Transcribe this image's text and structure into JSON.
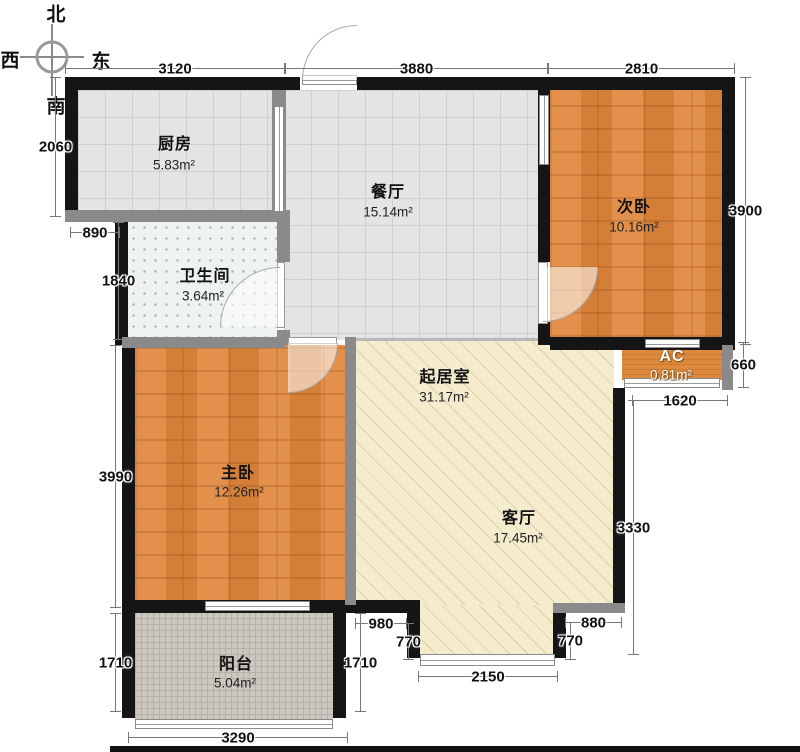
{
  "title": "两室户型图",
  "compass": {
    "north": "北",
    "west": "西",
    "east": "东",
    "south": "南",
    "cx": 52,
    "cy": 57,
    "r": 15,
    "labels": [
      {
        "key": "north",
        "x": 56,
        "y": 13
      },
      {
        "key": "west",
        "x": 10,
        "y": 59
      },
      {
        "key": "east",
        "x": 101,
        "y": 60
      },
      {
        "key": "south",
        "x": 56,
        "y": 105
      }
    ]
  },
  "colors": {
    "wall_exterior": "#151515",
    "wall_interior": "#8a8a8a",
    "wood_floor": "#e0873c",
    "tile_floor": "#e4e4e6",
    "living_floor": "#f5ecce",
    "balcony_floor": "#ccc8c0",
    "bath_floor": "#eef2f0",
    "dim_line": "#777777"
  },
  "floors": [
    {
      "id": "kitchen",
      "type": "tile",
      "rect": [
        78,
        90,
        196,
        122
      ]
    },
    {
      "id": "dining",
      "type": "tile",
      "rect": [
        284,
        90,
        256,
        250
      ]
    },
    {
      "id": "bedroom2",
      "type": "wood",
      "rect": [
        550,
        90,
        172,
        247
      ]
    },
    {
      "id": "bathroom",
      "type": "bath",
      "rect": [
        128,
        222,
        150,
        116
      ]
    },
    {
      "id": "master",
      "type": "wood",
      "rect": [
        135,
        345,
        211,
        257
      ]
    },
    {
      "id": "living-main",
      "type": "living",
      "rect": [
        354,
        340,
        260,
        265
      ]
    },
    {
      "id": "living-south",
      "type": "living",
      "rect": [
        418,
        605,
        137,
        50
      ]
    },
    {
      "id": "ac",
      "type": "wood-h",
      "rect": [
        622,
        350,
        100,
        30
      ]
    },
    {
      "id": "balcony",
      "type": "balcony",
      "rect": [
        135,
        612,
        198,
        108
      ]
    }
  ],
  "rooms": [
    {
      "id": "kitchen",
      "label": "厨房",
      "area": "5.83m²",
      "label_at": [
        175,
        142
      ],
      "area_at": [
        174,
        165
      ],
      "light": false
    },
    {
      "id": "dining",
      "label": "餐厅",
      "area": "15.14m²",
      "label_at": [
        388,
        190
      ],
      "area_at": [
        388,
        212
      ],
      "light": false
    },
    {
      "id": "bedroom2",
      "label": "次卧",
      "area": "10.16m²",
      "label_at": [
        634,
        205
      ],
      "area_at": [
        634,
        227
      ],
      "light": false
    },
    {
      "id": "bathroom",
      "label": "卫生间",
      "area": "3.64m²",
      "label_at": [
        205,
        274
      ],
      "area_at": [
        203,
        296
      ],
      "light": false
    },
    {
      "id": "living",
      "label": "起居室",
      "area": "31.17m²",
      "label_at": [
        445,
        375
      ],
      "area_at": [
        444,
        397
      ],
      "light": false
    },
    {
      "id": "parlor",
      "label": "客厅",
      "area": "17.45m²",
      "label_at": [
        519,
        516
      ],
      "area_at": [
        518,
        538
      ],
      "light": false
    },
    {
      "id": "master",
      "label": "主卧",
      "area": "12.26m²",
      "label_at": [
        238,
        471
      ],
      "area_at": [
        239,
        492
      ],
      "light": false
    },
    {
      "id": "ac",
      "label": "AC",
      "area": "0.81m²",
      "label_at": [
        672,
        357
      ],
      "area_at": [
        671,
        375
      ],
      "light": true
    },
    {
      "id": "balcony",
      "label": "阳台",
      "area": "5.04m²",
      "label_at": [
        236,
        662
      ],
      "area_at": [
        235,
        683
      ],
      "light": false
    }
  ],
  "walls": [
    {
      "id": "top-left",
      "type": "ext",
      "rect": [
        65,
        77,
        235,
        13
      ]
    },
    {
      "id": "top-right",
      "type": "ext",
      "rect": [
        357,
        77,
        378,
        13
      ]
    },
    {
      "id": "right-upper",
      "type": "ext",
      "rect": [
        722,
        90,
        13,
        255
      ]
    },
    {
      "id": "left-kitchen",
      "type": "ext",
      "rect": [
        65,
        90,
        13,
        132
      ]
    },
    {
      "id": "left-bath",
      "type": "ext",
      "rect": [
        115,
        222,
        13,
        123
      ]
    },
    {
      "id": "left-master",
      "type": "ext",
      "rect": [
        122,
        345,
        13,
        267
      ]
    },
    {
      "id": "left-balcony",
      "type": "ext",
      "rect": [
        122,
        612,
        13,
        106
      ]
    },
    {
      "id": "right-balcony",
      "type": "ext",
      "rect": [
        333,
        612,
        13,
        106
      ]
    },
    {
      "id": "master-bottom",
      "type": "ext",
      "rect": [
        122,
        600,
        298,
        13
      ]
    },
    {
      "id": "step-v-left",
      "type": "ext",
      "rect": [
        407,
        613,
        13,
        45
      ]
    },
    {
      "id": "step-v-right",
      "type": "ext",
      "rect": [
        553,
        610,
        13,
        48
      ]
    },
    {
      "id": "living-right",
      "type": "ext",
      "rect": [
        613,
        388,
        12,
        222
      ]
    },
    {
      "id": "bed2-wall-upper",
      "type": "ext",
      "rect": [
        538,
        90,
        12,
        172
      ]
    },
    {
      "id": "bed2-wall-lower",
      "type": "ext",
      "rect": [
        538,
        322,
        12,
        23
      ]
    },
    {
      "id": "ac-top",
      "type": "ext",
      "rect": [
        550,
        337,
        185,
        13
      ]
    },
    {
      "id": "ac-right",
      "type": "int",
      "rect": [
        722,
        345,
        11,
        45
      ]
    },
    {
      "id": "kitchen-bottom",
      "type": "int",
      "rect": [
        65,
        210,
        225,
        12
      ]
    },
    {
      "id": "kitchen-divider",
      "type": "int",
      "rect": [
        272,
        90,
        14,
        125
      ]
    },
    {
      "id": "bath-right-up",
      "type": "int",
      "rect": [
        277,
        215,
        13,
        47
      ]
    },
    {
      "id": "bath-right-dn",
      "type": "int",
      "rect": [
        277,
        330,
        13,
        15
      ]
    },
    {
      "id": "master-top-l",
      "type": "int",
      "rect": [
        122,
        337,
        163,
        11
      ]
    },
    {
      "id": "master-right",
      "type": "int",
      "rect": [
        345,
        337,
        11,
        268
      ]
    },
    {
      "id": "step-h-right",
      "type": "int",
      "rect": [
        553,
        603,
        72,
        10
      ]
    },
    {
      "id": "dining-living-line",
      "type": "thin",
      "rect": [
        356,
        338,
        182,
        3
      ]
    }
  ],
  "windows": [
    {
      "id": "entry-sill",
      "orient": "h",
      "rect": [
        302,
        75,
        55,
        10
      ]
    },
    {
      "id": "kitchen-slider",
      "orient": "v",
      "rect": [
        274,
        106,
        10,
        106
      ]
    },
    {
      "id": "bed2-partition",
      "orient": "v",
      "rect": [
        539,
        95,
        10,
        70
      ]
    },
    {
      "id": "ac-window-top",
      "orient": "h",
      "rect": [
        645,
        339,
        55,
        9
      ]
    },
    {
      "id": "ac-window-bottom",
      "orient": "h",
      "rect": [
        624,
        378,
        96,
        10
      ]
    },
    {
      "id": "master-window",
      "orient": "h",
      "rect": [
        205,
        601,
        105,
        10
      ]
    },
    {
      "id": "living-window",
      "orient": "h",
      "rect": [
        420,
        654,
        135,
        12
      ]
    },
    {
      "id": "balcony-rail",
      "orient": "h",
      "rect": [
        135,
        719,
        198,
        10
      ]
    }
  ],
  "doors": [
    {
      "id": "entry-door",
      "arc": [
        302,
        25,
        55,
        55
      ],
      "corner": "tl"
    },
    {
      "id": "master-door",
      "leaf": [
        288,
        337,
        49,
        7
      ],
      "arc": [
        288,
        343,
        50,
        50
      ],
      "corner": "br"
    },
    {
      "id": "bath-door",
      "leaf": [
        277,
        262,
        8,
        66
      ],
      "arc": [
        220,
        267,
        60,
        60
      ],
      "corner": "tl"
    },
    {
      "id": "bedroom2-door",
      "leaf": [
        538,
        262,
        10,
        62
      ],
      "arc": [
        543,
        267,
        55,
        55
      ],
      "corner": "br"
    }
  ],
  "dimensions": [
    {
      "id": "top-3120",
      "orient": "h",
      "x": 65,
      "y": 68,
      "len": 220,
      "label": "3120"
    },
    {
      "id": "top-3880",
      "orient": "h",
      "x": 285,
      "y": 68,
      "len": 263,
      "label": "3880"
    },
    {
      "id": "top-2810",
      "orient": "h",
      "x": 548,
      "y": 68,
      "len": 187,
      "label": "2810"
    },
    {
      "id": "left-2060",
      "orient": "v",
      "x": 55,
      "y": 77,
      "len": 140,
      "label": "2060"
    },
    {
      "id": "left-890",
      "orient": "h",
      "x": 70,
      "y": 232,
      "len": 50,
      "label": "890"
    },
    {
      "id": "left-1840",
      "orient": "v",
      "x": 118,
      "y": 222,
      "len": 118,
      "label": "1840"
    },
    {
      "id": "left-3990",
      "orient": "v",
      "x": 115,
      "y": 345,
      "len": 263,
      "label": "3990"
    },
    {
      "id": "left-1710",
      "orient": "v",
      "x": 115,
      "y": 613,
      "len": 99,
      "label": "1710"
    },
    {
      "id": "bottom-3290",
      "orient": "h",
      "x": 128,
      "y": 737,
      "len": 220,
      "label": "3290"
    },
    {
      "id": "right-3900",
      "orient": "v",
      "x": 745,
      "y": 77,
      "len": 268,
      "label": "3900"
    },
    {
      "id": "right-660",
      "orient": "v",
      "x": 743,
      "y": 342,
      "len": 46,
      "label": "660"
    },
    {
      "id": "right-1620",
      "orient": "h",
      "x": 632,
      "y": 400,
      "len": 96,
      "label": "1620"
    },
    {
      "id": "right-3330",
      "orient": "v",
      "x": 633,
      "y": 400,
      "len": 255,
      "label": "3330"
    },
    {
      "id": "mid-880",
      "orient": "h",
      "x": 565,
      "y": 622,
      "len": 57,
      "label": "880"
    },
    {
      "id": "mid-770-r",
      "orient": "v",
      "x": 570,
      "y": 622,
      "len": 38,
      "label": "770"
    },
    {
      "id": "mid-980",
      "orient": "h",
      "x": 355,
      "y": 623,
      "len": 52,
      "label": "980"
    },
    {
      "id": "mid-770-l",
      "orient": "v",
      "x": 408,
      "y": 623,
      "len": 37,
      "label": "770"
    },
    {
      "id": "mid-2150",
      "orient": "h",
      "x": 418,
      "y": 676,
      "len": 140,
      "label": "2150"
    },
    {
      "id": "mid-1710",
      "orient": "v",
      "x": 360,
      "y": 613,
      "len": 99,
      "label": "1710"
    }
  ],
  "bottom_bar": {
    "rect": [
      110,
      746,
      690,
      6
    ]
  }
}
